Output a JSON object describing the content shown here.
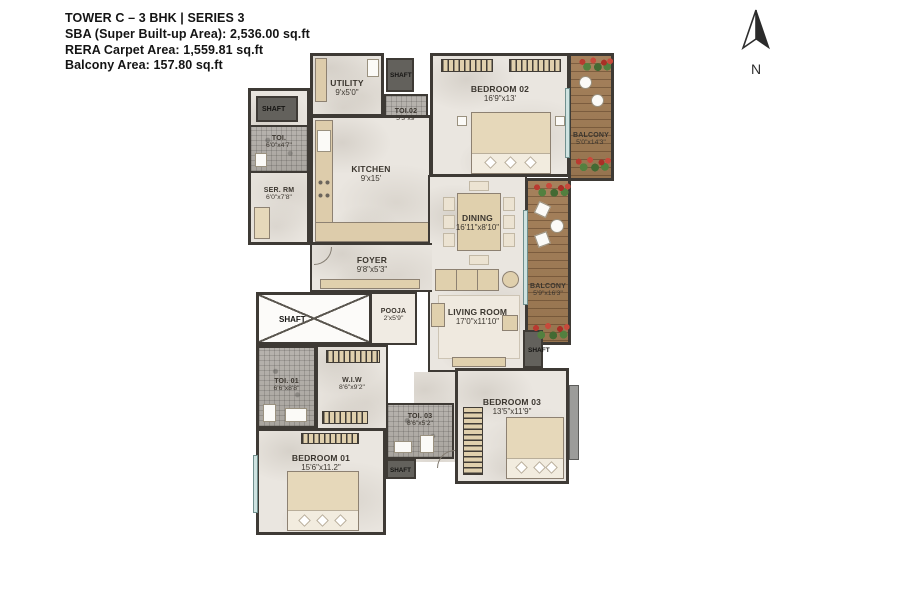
{
  "header": {
    "title": "TOWER C – 3 BHK | SERIES 3",
    "sba": "SBA (Super Built-up Area): 2,536.00 sq.ft",
    "rera": "RERA Carpet Area: 1,559.81 sq.ft",
    "balcony": "Balcony Area: 157.80 sq.ft"
  },
  "compass": {
    "label": "N"
  },
  "rooms": {
    "utility": {
      "name": "UTILITY",
      "dims": "9'x5'0\""
    },
    "shaft_top": {
      "name": "SHAFT"
    },
    "toi_02": {
      "name": "TOI.02",
      "dims": "5'3\"x9'"
    },
    "bedroom_02": {
      "name": "BEDROOM 02",
      "dims": "16'9\"x13'"
    },
    "balcony_top": {
      "name": "BALCONY",
      "dims": "5'0\"x14'3\""
    },
    "shaft_left": {
      "name": "SHAFT"
    },
    "toi_left": {
      "name": "TOI.",
      "dims": "6'0\"x4'7\""
    },
    "ser_rm": {
      "name": "SER. RM",
      "dims": "6'0\"x7'8\""
    },
    "kitchen": {
      "name": "KITCHEN",
      "dims": "9'x15'"
    },
    "dining": {
      "name": "DINING",
      "dims": "16'11\"x8'10\""
    },
    "balcony_right": {
      "name": "BALCONY",
      "dims": "5'9\"x16'3\""
    },
    "foyer": {
      "name": "FOYER",
      "dims": "9'8\"x5'3\""
    },
    "shaft_main": {
      "name": "SHAFT"
    },
    "pooja": {
      "name": "POOJA",
      "dims": "2'x5'9\""
    },
    "living_room": {
      "name": "LIVING ROOM",
      "dims": "17'0\"x11'10\""
    },
    "shaft_mid": {
      "name": "SHAFT"
    },
    "toi_01": {
      "name": "TOI. 01",
      "dims": "6'6\"x8'8\""
    },
    "wiw": {
      "name": "W.I.W",
      "dims": "8'6\"x9'2\""
    },
    "bedroom_01": {
      "name": "BEDROOM 01",
      "dims": "15'6\"x11.2\""
    },
    "toi_03": {
      "name": "TOI. 03",
      "dims": "8'6\"x5'2\""
    },
    "shaft_bottom": {
      "name": "SHAFT"
    },
    "bedroom_03": {
      "name": "BEDROOM 03",
      "dims": "13'5\"x11'9\""
    }
  },
  "colors": {
    "wall": "#3e3a35",
    "floor": "#eae6e0",
    "balcony_wood": "#a5815c",
    "toilet_mosaic": "#b0aca6",
    "furniture_tan": "#e0d0ad",
    "shaft_gray": "#63615c",
    "flower_red": "#b93a30",
    "leaf_green": "#53803f",
    "window_teal": "#cfe3e1"
  }
}
